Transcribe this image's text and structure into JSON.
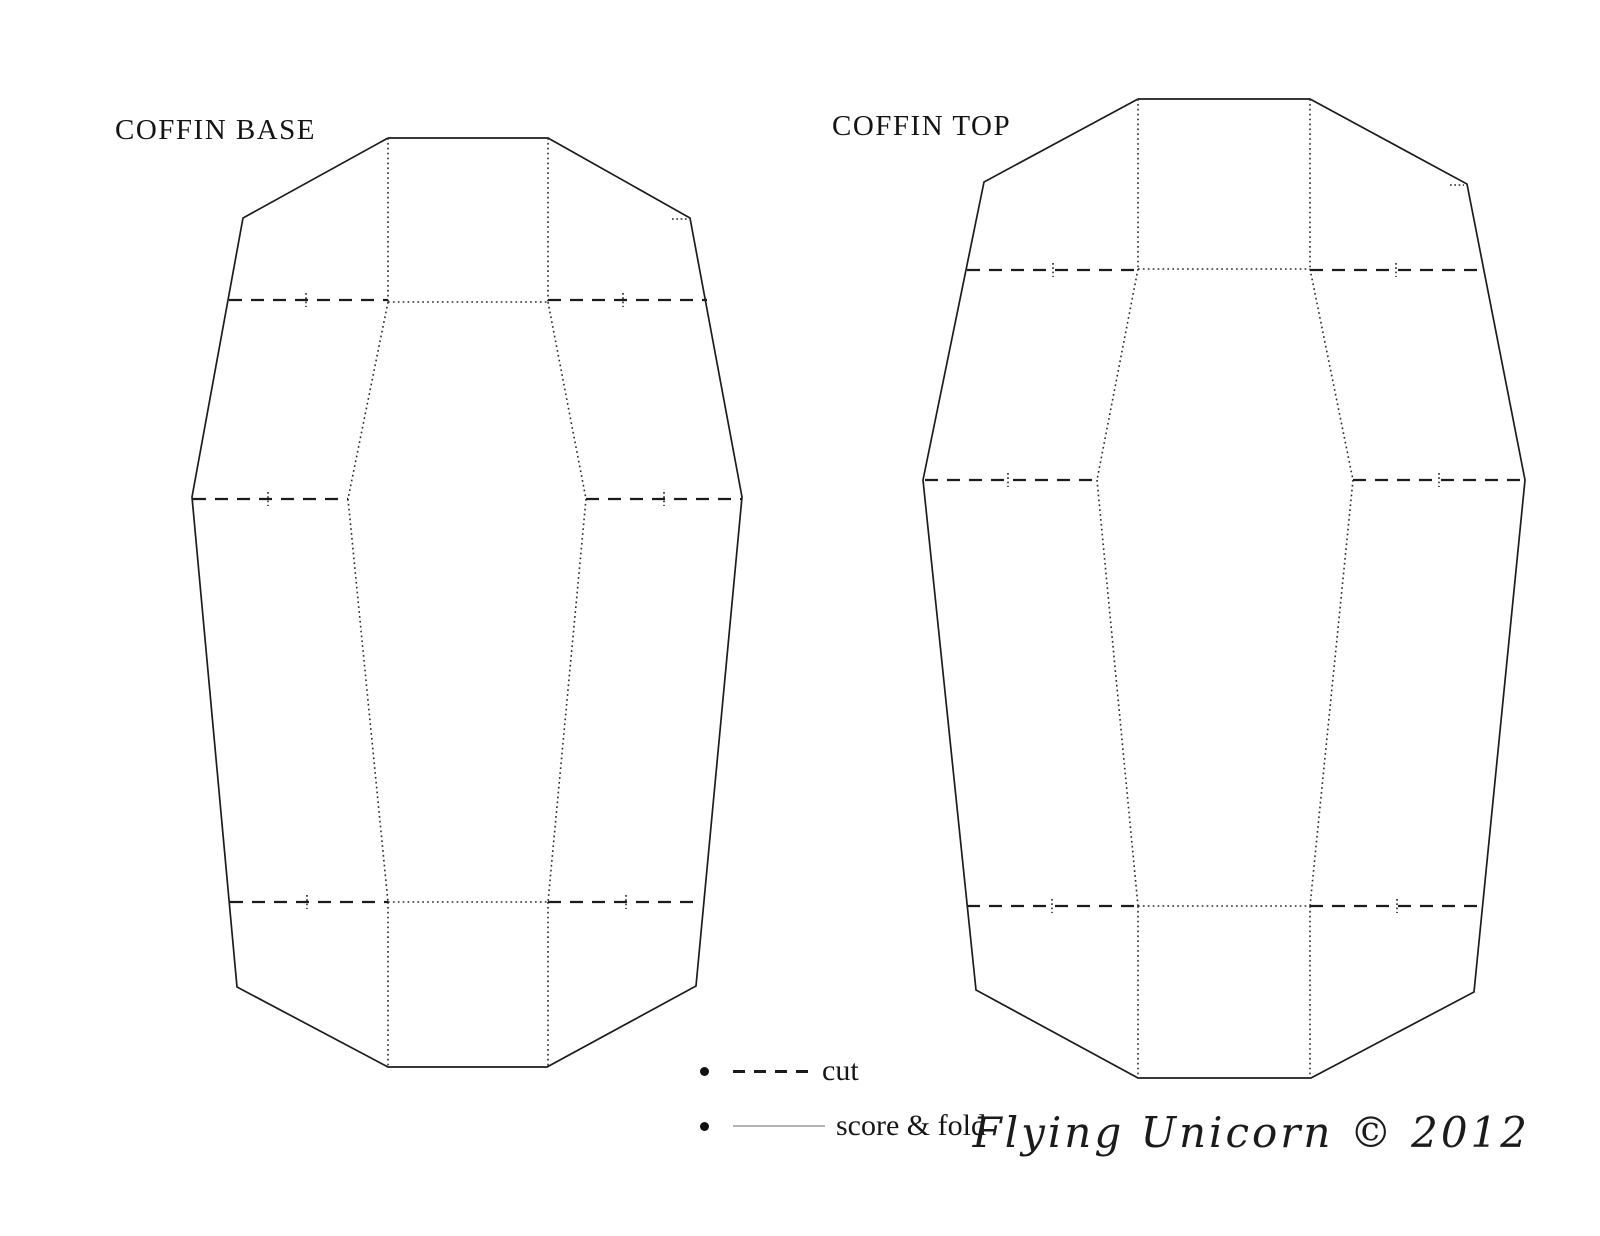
{
  "page": {
    "width": 1600,
    "height": 1236,
    "background": "#ffffff"
  },
  "titles": {
    "base": "COFFIN BASE",
    "top": "COFFIN TOP"
  },
  "legend": {
    "items": [
      {
        "id": "cut",
        "label": "cut",
        "line_style": "dashed",
        "line_color": "#1a1a1a"
      },
      {
        "id": "score-fold",
        "label": "score & fold",
        "line_style": "solid",
        "line_color": "#b3b3b3"
      }
    ]
  },
  "signature": {
    "text": "Flying Unicorn © 2012"
  },
  "colors": {
    "outline": "#1c1c1c",
    "cut_dashed": "#1c1c1c",
    "fold_dotted": "#2a2a2a",
    "background": "#ffffff"
  },
  "diagram": {
    "shapes": [
      {
        "id": "coffin-base",
        "outline": [
          [
            388,
            138
          ],
          [
            548,
            138
          ],
          [
            690,
            218
          ],
          [
            742,
            497
          ],
          [
            696,
            986
          ],
          [
            547,
            1067
          ],
          [
            388,
            1067
          ],
          [
            237,
            987
          ],
          [
            192,
            497
          ],
          [
            243,
            218
          ]
        ],
        "fold_lines": [
          [
            [
              388,
              138
            ],
            [
              388,
              302
            ]
          ],
          [
            [
              548,
              138
            ],
            [
              548,
              302
            ]
          ],
          [
            [
              388,
              302
            ],
            [
              548,
              302
            ]
          ],
          [
            [
              388,
              302
            ],
            [
              348,
              499
            ]
          ],
          [
            [
              548,
              302
            ],
            [
              586,
              499
            ]
          ],
          [
            [
              348,
              499
            ],
            [
              388,
              902
            ]
          ],
          [
            [
              586,
              499
            ],
            [
              548,
              902
            ]
          ],
          [
            [
              388,
              902
            ],
            [
              548,
              902
            ]
          ],
          [
            [
              388,
              902
            ],
            [
              388,
              1067
            ]
          ],
          [
            [
              548,
              902
            ],
            [
              548,
              1067
            ]
          ]
        ],
        "cut_lines": [
          {
            "from": [
              229,
              300
            ],
            "to": [
              388,
              300
            ],
            "notch_x": 306
          },
          {
            "from": [
              548,
              300
            ],
            "to": [
              707,
              300
            ],
            "notch_x": 623
          },
          {
            "from": [
              193,
              499
            ],
            "to": [
              348,
              499
            ],
            "notch_x": 268
          },
          {
            "from": [
              586,
              499
            ],
            "to": [
              741,
              499
            ],
            "notch_x": 664
          },
          {
            "from": [
              230,
              902
            ],
            "to": [
              388,
              902
            ],
            "notch_x": 307
          },
          {
            "from": [
              548,
              902
            ],
            "to": [
              700,
              902
            ],
            "notch_x": 626
          }
        ],
        "corner_ticks": [
          [
            [
              672,
              219
            ],
            [
              688,
              219
            ]
          ]
        ]
      },
      {
        "id": "coffin-top",
        "outline": [
          [
            1138,
            99
          ],
          [
            1310,
            99
          ],
          [
            1467,
            184
          ],
          [
            1525,
            480
          ],
          [
            1474,
            992
          ],
          [
            1311,
            1078
          ],
          [
            1138,
            1078
          ],
          [
            976,
            990
          ],
          [
            923,
            480
          ],
          [
            984,
            182
          ]
        ],
        "fold_lines": [
          [
            [
              1138,
              99
            ],
            [
              1138,
              269
            ]
          ],
          [
            [
              1310,
              99
            ],
            [
              1310,
              269
            ]
          ],
          [
            [
              1138,
              269
            ],
            [
              1310,
              269
            ]
          ],
          [
            [
              1138,
              269
            ],
            [
              1097,
              480
            ]
          ],
          [
            [
              1310,
              269
            ],
            [
              1353,
              480
            ]
          ],
          [
            [
              1097,
              480
            ],
            [
              1138,
              906
            ]
          ],
          [
            [
              1353,
              480
            ],
            [
              1310,
              906
            ]
          ],
          [
            [
              1138,
              906
            ],
            [
              1310,
              906
            ]
          ],
          [
            [
              1138,
              906
            ],
            [
              1138,
              1078
            ]
          ],
          [
            [
              1310,
              906
            ],
            [
              1310,
              1078
            ]
          ]
        ],
        "cut_lines": [
          {
            "from": [
              967,
              270
            ],
            "to": [
              1138,
              270
            ],
            "notch_x": 1053
          },
          {
            "from": [
              1310,
              270
            ],
            "to": [
              1483,
              270
            ],
            "notch_x": 1396
          },
          {
            "from": [
              925,
              480
            ],
            "to": [
              1097,
              480
            ],
            "notch_x": 1008
          },
          {
            "from": [
              1353,
              480
            ],
            "to": [
              1524,
              480
            ],
            "notch_x": 1439
          },
          {
            "from": [
              967,
              906
            ],
            "to": [
              1138,
              906
            ],
            "notch_x": 1052
          },
          {
            "from": [
              1310,
              906
            ],
            "to": [
              1480,
              906
            ],
            "notch_x": 1397
          }
        ],
        "corner_ticks": [
          [
            [
              1450,
              185
            ],
            [
              1464,
              185
            ]
          ]
        ]
      }
    ]
  }
}
